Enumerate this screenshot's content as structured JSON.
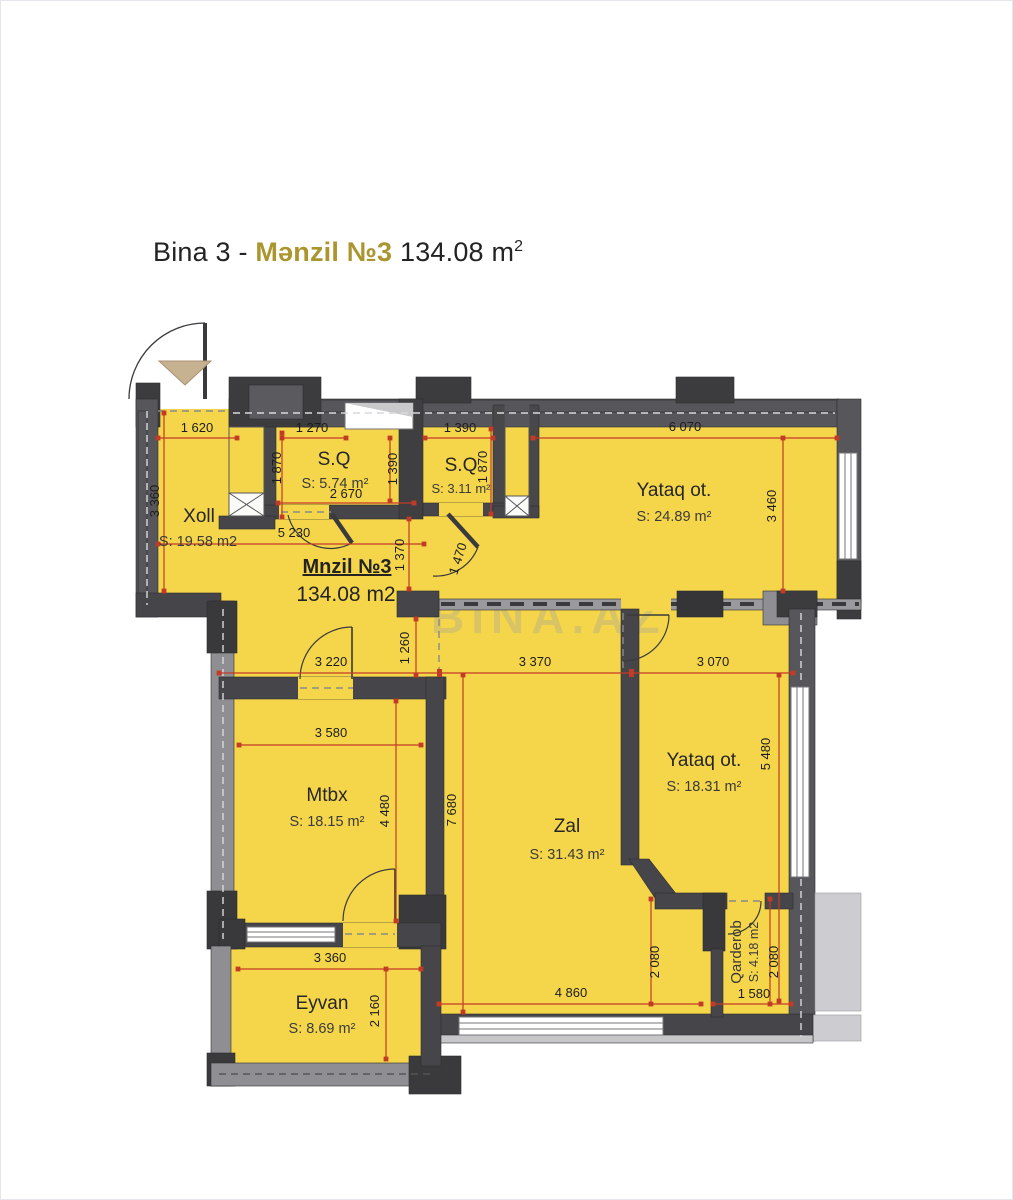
{
  "title": {
    "prefix": "Bina 3 - ",
    "accent": "Mənzil №3",
    "area_value": "134.08 m",
    "area_sup": "2",
    "accent_color": "#ab952e"
  },
  "watermark": "BINA.AZ",
  "unit_label": {
    "name": "Mnzil №3",
    "area": "134.08 m2"
  },
  "rooms": [
    {
      "id": "xoll",
      "name": "Xoll",
      "area": "S: 19.58 m2"
    },
    {
      "id": "sq1",
      "name": "S.Q",
      "area": "S: 5.74 m²"
    },
    {
      "id": "sq2",
      "name": "S.Q",
      "area": "S: 3.11 m²"
    },
    {
      "id": "yataq1",
      "name": "Yataq ot.",
      "area": "S: 24.89 m²"
    },
    {
      "id": "mtbx",
      "name": "Mtbx",
      "area": "S: 18.15 m²"
    },
    {
      "id": "zal",
      "name": "Zal",
      "area": "S: 31.43 m²"
    },
    {
      "id": "yataq2",
      "name": "Yataq ot.",
      "area": "S: 18.31 m²"
    },
    {
      "id": "qarderob",
      "name": "Qarderob",
      "area": "S: 4.18 m2"
    },
    {
      "id": "eyvan",
      "name": "Eyvan",
      "area": "S: 8.69 m²"
    }
  ],
  "dimensions": [
    "1 620",
    "3 360",
    "1 270",
    "1 870",
    "2 670",
    "1 390",
    "1 390",
    "1 870",
    "6 070",
    "3 460",
    "5 230",
    "1 370",
    "1 470",
    "1 260",
    "3 220",
    "3 370",
    "3 070",
    "3 580",
    "4 480",
    "7 680",
    "5 480",
    "2 080",
    "2 080",
    "1 580",
    "4 860",
    "3 360",
    "2 160"
  ],
  "colors": {
    "room_fill": "#F5D64B",
    "wall_dark": "#454549",
    "wall_light": "#9A9A9E",
    "dimension_red": "#C23B27",
    "title_accent": "#AB952E"
  }
}
